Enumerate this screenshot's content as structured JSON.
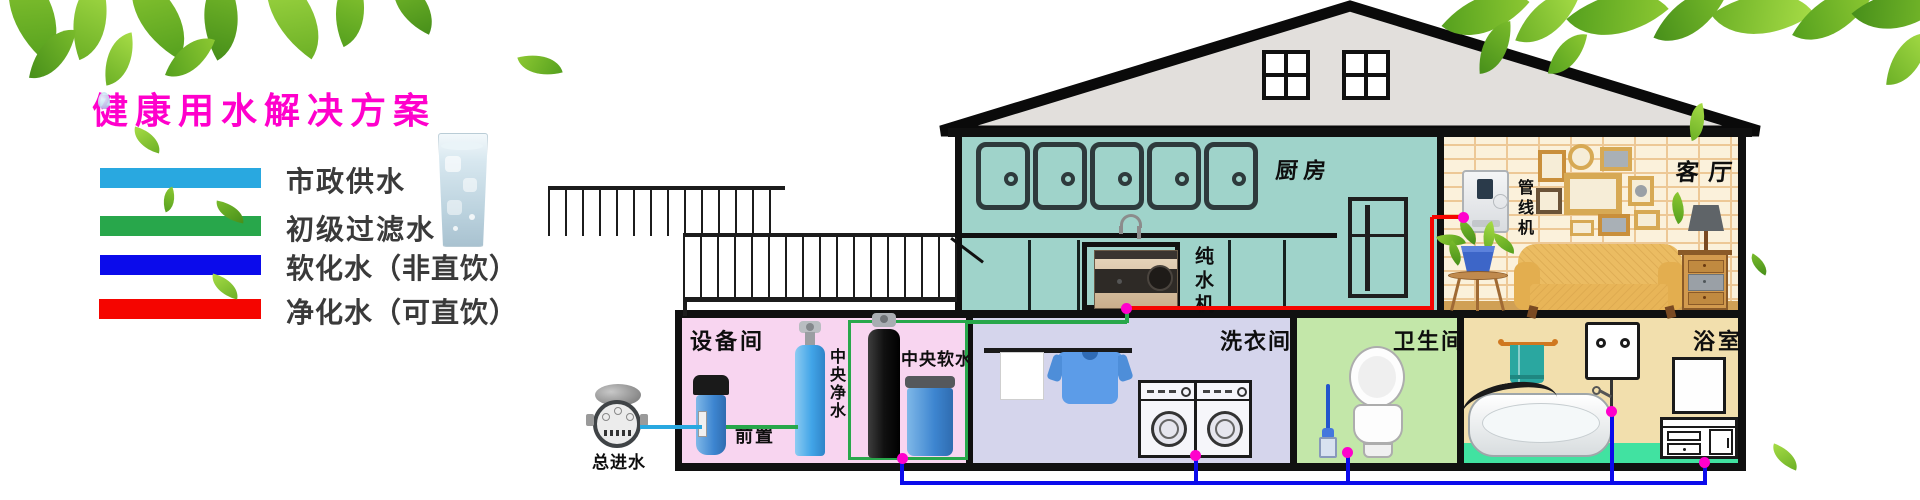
{
  "title": "健康用水解决方案",
  "legend": {
    "items": [
      {
        "label": "市政供水",
        "color": "#29A8E0"
      },
      {
        "label": "初级过滤水",
        "color": "#28A74B"
      },
      {
        "label": "软化水（非直饮）",
        "color": "#0B0BEB"
      },
      {
        "label": "净化水（可直饮）",
        "color": "#F50500"
      }
    ]
  },
  "house": {
    "kitchen_label": "厨房",
    "living_label": "客厅",
    "equipment_label": "设备间",
    "laundry_label": "洗衣间",
    "toilet_label": "卫生间",
    "bath_label": "浴室"
  },
  "devices": {
    "inlet_label": "总进水",
    "prefilter_label": "前置",
    "purifier_label": "中央净水",
    "softener_label": "中央软水",
    "pure_machine_label": "纯水机",
    "pipeline_label": "管线机"
  },
  "pipes": {
    "municipal_color": "#29A8E0",
    "filtered_color": "#28A74B",
    "softened_color": "#0B0BEB",
    "purified_color": "#F50500",
    "junction_color": "#FF00CC"
  }
}
